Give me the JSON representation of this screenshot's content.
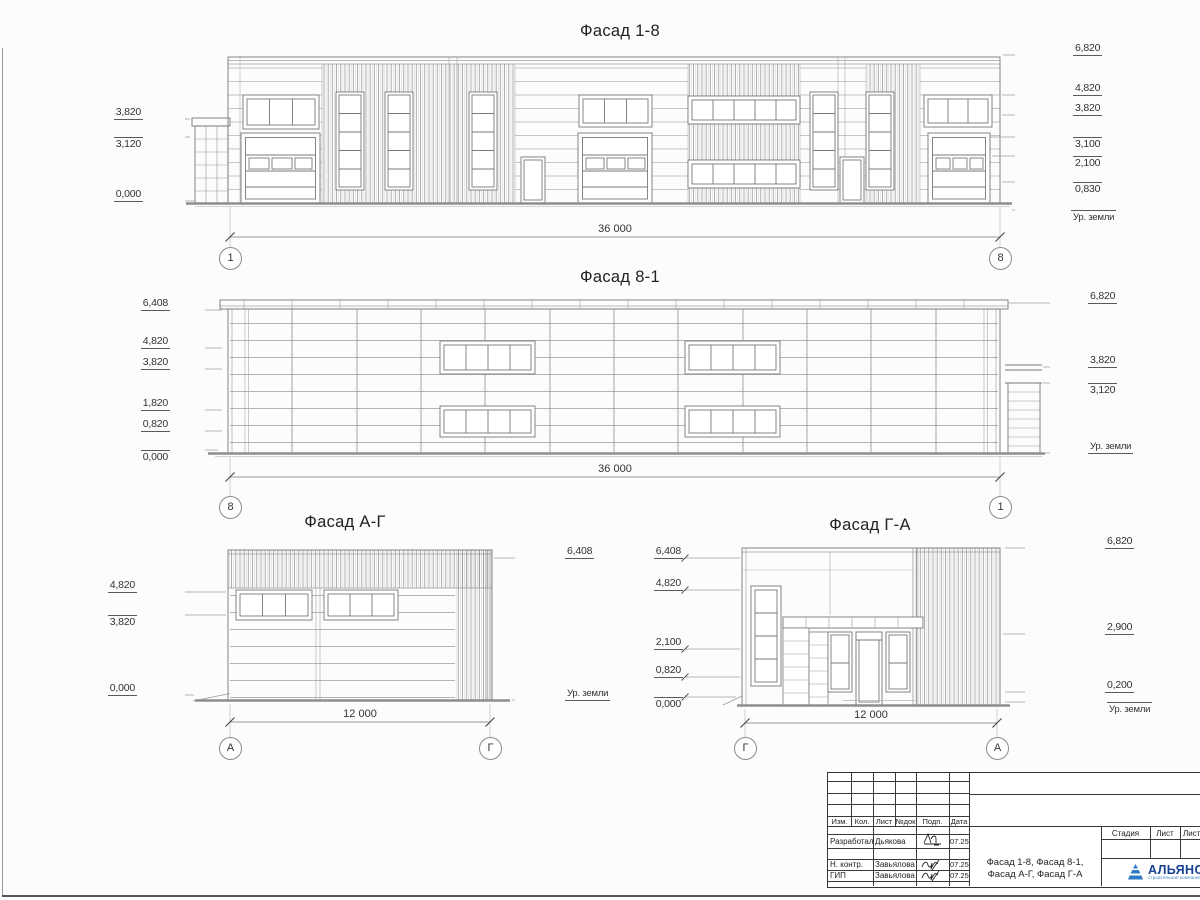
{
  "f18": {
    "title": "Фасад 1-8",
    "dim": "36 000",
    "bl": "1",
    "br": "8",
    "left": [
      "3,820",
      "3,120",
      "0,000"
    ],
    "right": [
      "6,820",
      "4,820",
      "3,820",
      "3,100",
      "2,100",
      "0,830",
      "Ур. земли"
    ]
  },
  "f81": {
    "title": "Фасад 8-1",
    "dim": "36 000",
    "bl": "8",
    "br": "1",
    "left": [
      "6,408",
      "4,820",
      "3,820",
      "1,820",
      "0,820",
      "0,000"
    ],
    "right": [
      "6,820",
      "3,820",
      "3,120",
      "Ур. земли"
    ]
  },
  "fag": {
    "title": "Фасад А-Г",
    "dim": "12 000",
    "bl": "А",
    "br": "Г",
    "left": [
      "4,820",
      "3,820",
      "0,000"
    ],
    "right": [
      "6,408",
      "Ур. земли"
    ]
  },
  "fga": {
    "title": "Фасад Г-А",
    "dim": "12 000",
    "bl": "Г",
    "br": "А",
    "left": [
      "6,408",
      "4,820",
      "2,100",
      "0,820",
      "0,000"
    ],
    "right": [
      "6,820",
      "2,900",
      "0,200",
      "Ур. земли"
    ]
  },
  "tb": {
    "cols": [
      "Изм.",
      "Кол.",
      "Лист",
      "№док",
      "Подп.",
      "Дата"
    ],
    "rows": [
      {
        "role": "Разработал",
        "name": "Дьякова",
        "date": "07.25"
      },
      {
        "role": "Н. контр.",
        "name": "Завьялова",
        "date": "07.25"
      },
      {
        "role": "ГИП",
        "name": "Завьялова",
        "date": "07.25"
      }
    ],
    "doc1": "Фасад 1-8, Фасад 8-1,",
    "doc2": "Фасад А-Г, Фасад Г-А",
    "stage": [
      "Стадия",
      "Лист",
      "Листов"
    ],
    "logo": {
      "name": "АЛЬЯНС",
      "sub": "строительная компания",
      "text_color": "#16418f",
      "mark_color": "#2e7cc3"
    }
  }
}
